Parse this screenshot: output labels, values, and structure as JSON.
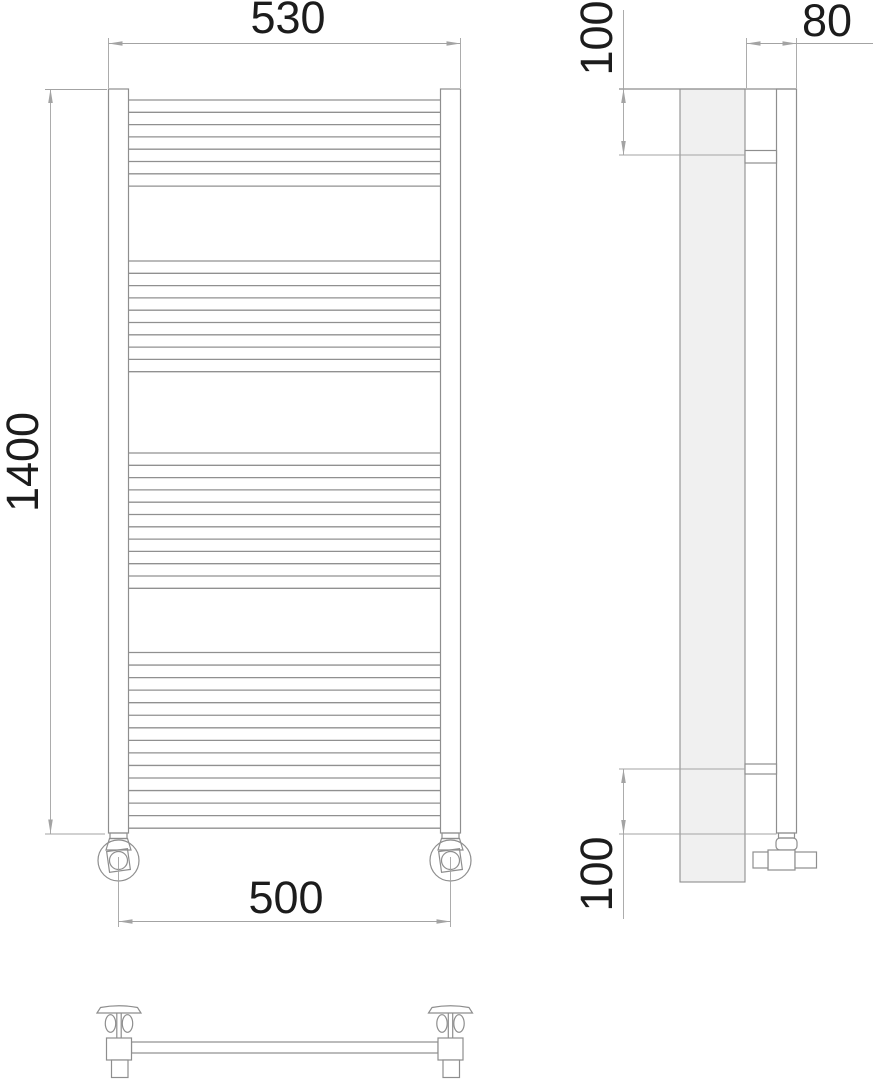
{
  "drawing": {
    "kind": "ladder-towel-rail-dimensional-drawing",
    "views": [
      "front",
      "side",
      "top"
    ]
  },
  "dimensions": {
    "overall_width": "530",
    "overall_height": "1400",
    "connection_spacing": "500",
    "wall_depth": "80",
    "bracket_offset_top": "100",
    "bracket_offset_bottom": "100"
  },
  "front_view": {
    "rung_x1": 128.5,
    "rung_x2": 440.5,
    "rung_groups": [
      {
        "start_y": 100,
        "step": 12.3,
        "count": 8
      },
      {
        "start_y": 261,
        "step": 12.3,
        "count": 10
      },
      {
        "start_y": 453,
        "step": 12.3,
        "count": 12
      },
      {
        "start_y": 652.5,
        "step": 12.55,
        "count": 15
      }
    ]
  },
  "colors": {
    "outline": "#8e8e8e",
    "rung": "#909090",
    "dim": "#a3a3a3",
    "text": "#1c1c1c",
    "panel-fill": "#f0f0f0",
    "bg": "#ffffff"
  }
}
